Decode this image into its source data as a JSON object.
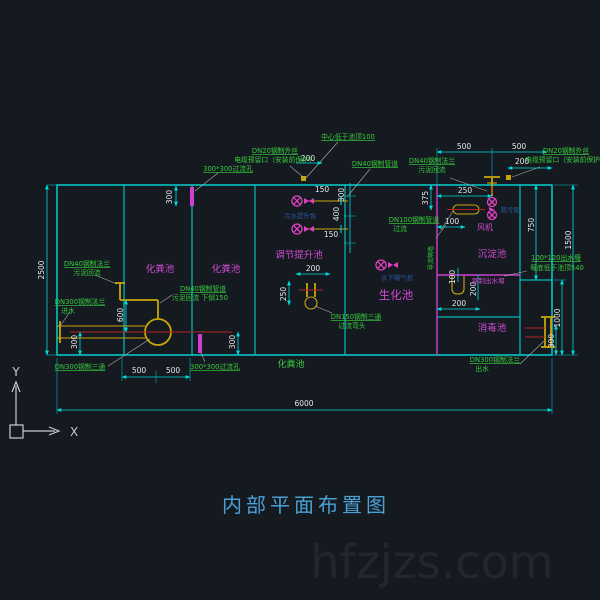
{
  "title": "内部平面布置图",
  "watermark": "hfzjzs.com",
  "axis": {
    "x_label": "X",
    "y_label": "Y"
  },
  "colors": {
    "background": "#151a21",
    "wall_line": "#00dcdc",
    "annotation_green": "#38c93c",
    "tank_magenta": "#d24ad2",
    "pipe_yellow": "#c9a50a",
    "centerline_red": "#b32424",
    "dimension_text": "#e2e8ea",
    "equipment_blue": "#28569c",
    "title_blue": "#4aa0d4",
    "watermark_gray": "#23272d"
  },
  "tanks": {
    "septic_1": "化粪池",
    "septic_2": "化粪池",
    "septic_bottom": "化粪池",
    "regulation_lift": "调节提升池",
    "biochemical": "生化池",
    "sedimentation": "沉淀池",
    "disinfection": "消毒池",
    "fan": "风机"
  },
  "equipment": {
    "lift_pump": "污水提升泵",
    "aerator": "水下曝气机",
    "submersible_pump": "潜污泵",
    "outlet_weir": "钢制出水堰",
    "guide_wall": "导流隔墙"
  },
  "annotations": {
    "center_below_top": "中心低于池顶100",
    "dn20_left_1": "DN20钢制外丝",
    "dn20_left_2": "电缆预留口（安装前保护）",
    "dn20_right_1": "DN20钢制外丝",
    "dn20_right_2": "电缆预留口（安装前保护）",
    "overflow_top": "300*300过流孔",
    "overflow_bottom": "300*300过流孔",
    "dn40_pipe_top": "DN40钢制管道",
    "dn40_flange_top_1": "DN40钢制法兰",
    "dn40_flange_top_2": "污泥回流",
    "dn40_flange_left_1": "DN40钢制法兰",
    "dn40_flange_left_2": "污泥回流",
    "dn40_pipe_left_1": "DN40钢制管道",
    "dn40_pipe_left_2": "污泥回流 下倒150",
    "dn300_flange_in_1": "DN300钢制法兰",
    "dn300_flange_in_2": "进水",
    "dn300_tee": "DN300钢制三通",
    "dn150_tee_1": "DN150钢制三通",
    "dn150_tee_2": "过流弯头",
    "dn100_pipe_1": "DN100钢制管道",
    "dn100_pipe_2": "过流",
    "weir_1": "100*120出水堰",
    "weir_2": "堰底低于池顶540",
    "dn300_flange_out_1": "DN300钢制法兰",
    "dn300_flange_out_2": "出水"
  },
  "dims": {
    "d2500": "2500",
    "d6000": "6000",
    "d1500": "1500",
    "d1000": "1000",
    "d750": "750",
    "d300_out": "300",
    "d500_tr1": "500",
    "d500_tr2": "500",
    "d200_tr": "200",
    "d250_tr": "250",
    "d375": "375",
    "d100_tr": "100",
    "d100_weir": "100",
    "d200_weir_v": "200",
    "d200_weir_h": "200",
    "d150_a": "150",
    "d300_rot": "300",
    "d400": "400",
    "d150_b": "150",
    "d200_reg": "200",
    "d250_reg": "250",
    "d200_cable": "200",
    "d300_slot_top": "300",
    "d300_bl": "300",
    "d300_br": "300",
    "d500_bl1": "500",
    "d500_bl2": "500",
    "d600": "600"
  }
}
